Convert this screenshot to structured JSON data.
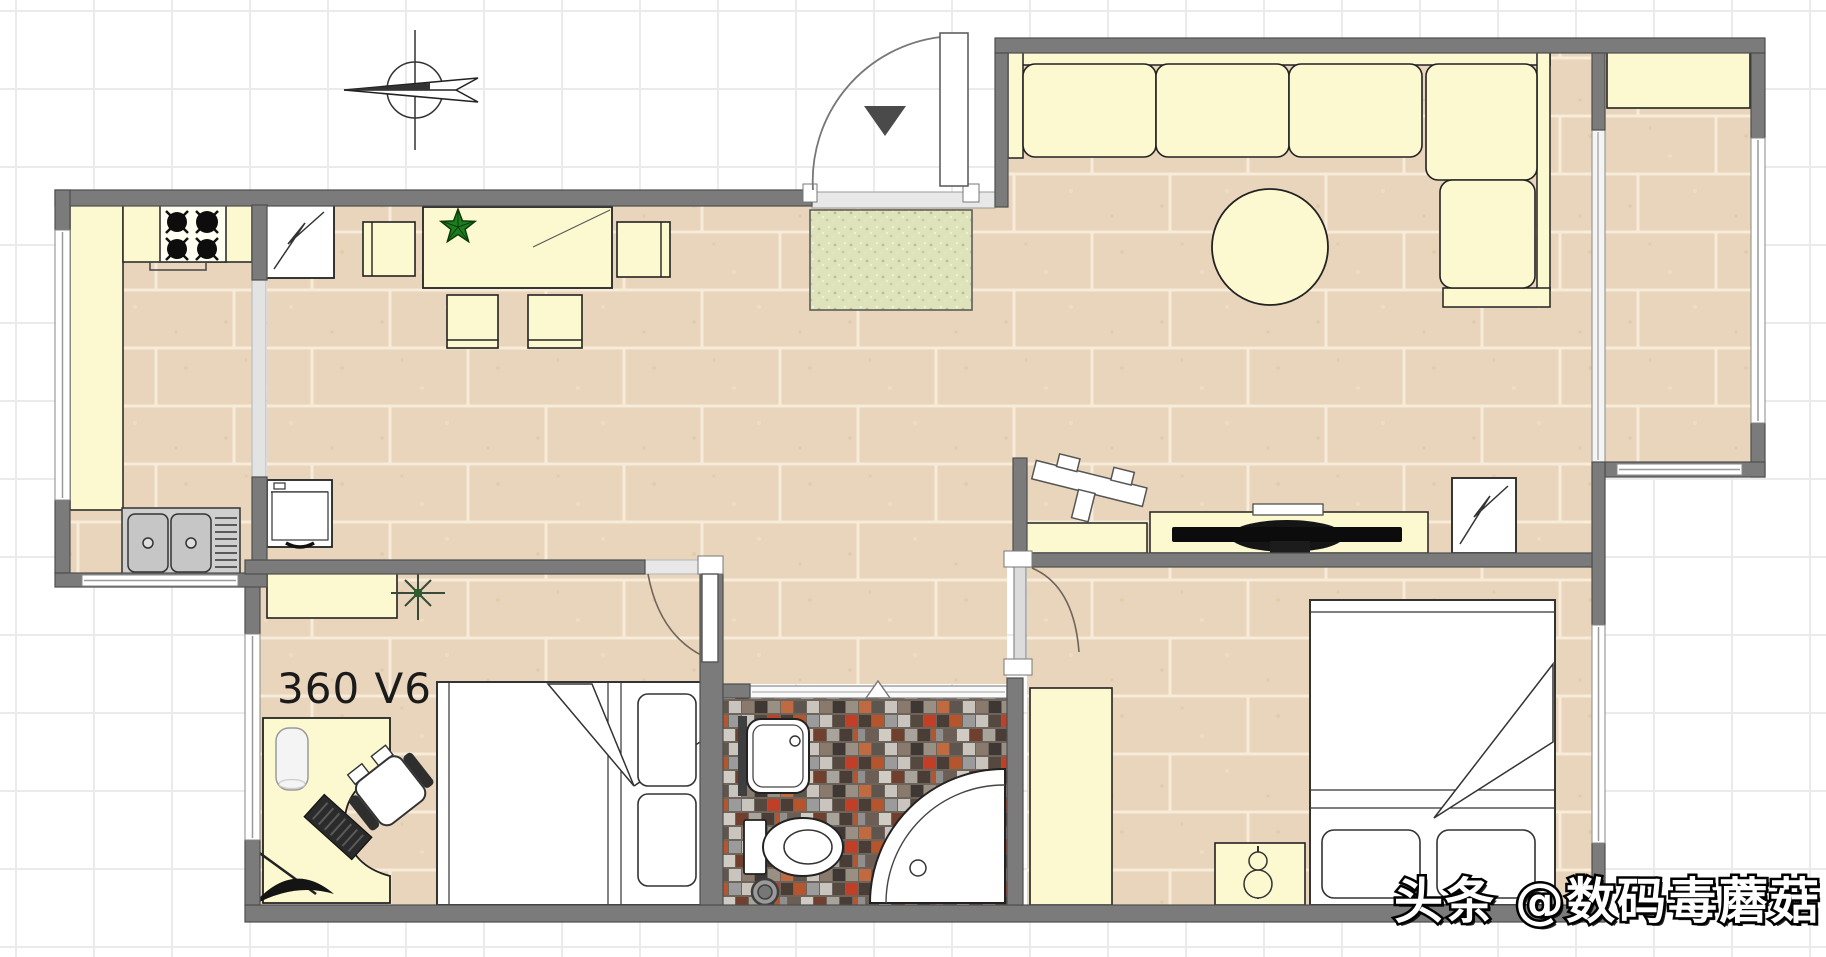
{
  "canvas": {
    "width": 1826,
    "height": 957,
    "kind": "floor-plan"
  },
  "labels": {
    "product": "360 V6",
    "watermark": "头条 @数码毒蘑菇"
  },
  "colors": {
    "background": "#ffffff",
    "grid_line": "#ebebeb",
    "wall_fill": "#7b7b7b",
    "wall_border": "#4e4e4e",
    "furniture_fill": "#fcf8d0",
    "furniture_stroke": "#222222",
    "floor_tile": "#e9d5bb",
    "floor_grout": "#f6ecd9",
    "mosaic_grout": "#6d645c",
    "doormat_green": "#dfe3bc",
    "plant_green": "#1e7d1e",
    "entry_arrow": "#4a4a4a",
    "tv_black": "#111111",
    "door_leaf_gray": "#dcdcdc",
    "window_white": "#ffffff"
  },
  "rooms": [
    "kitchen",
    "dining-area",
    "hallway",
    "living-room",
    "balcony",
    "bedroom",
    "bathroom",
    "master-bedroom"
  ],
  "icons": {
    "north-arrow-icon": "compass circle with left-pointing needle",
    "entry-arrow-icon": "dark triangle pointing into apartment",
    "stove-icon": "four black burners with cross ticks",
    "fridge-icon": "white square with lightning zigzag",
    "appliance-icon": "white square with lightning zigzag",
    "plant-star-icon": "green five-point star plant",
    "plant-cross-icon": "thin cross plant symbol",
    "lamp-icon": "two stacked circles with stick",
    "shower-icon": "quarter-circle shower tray",
    "toilet-icon": "tank and oval bowl",
    "drain-icon": "double circle floor drain"
  }
}
